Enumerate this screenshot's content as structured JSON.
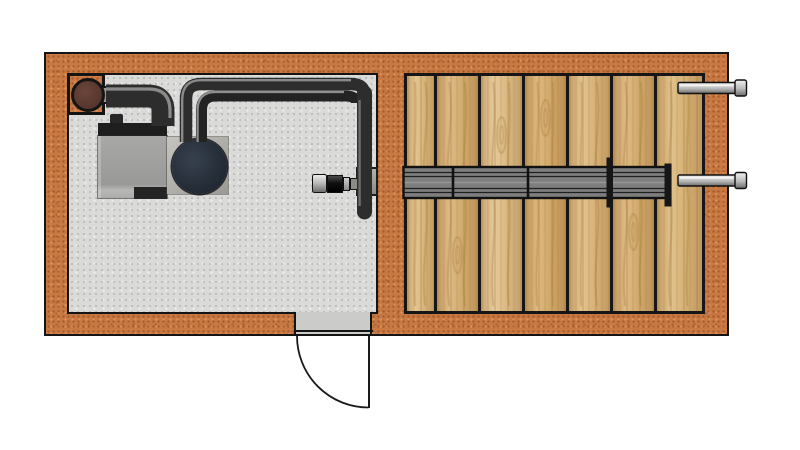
{
  "meta": {
    "diagram_type": "architectural floor plan, top view",
    "visible_text": "none"
  },
  "colors": {
    "background": "#ffffff",
    "outline": "#141414",
    "wall_base": "#c87842",
    "floor_base": "#dadad8",
    "threshold": "#cbcbc9",
    "plank_colors": [
      "#e0bd82",
      "#d9b173",
      "#e3c28b",
      "#d8ae6c",
      "#dfba7e",
      "#d9b071",
      "#ddb87a"
    ],
    "grain": "#a87c3e",
    "bundle_fill": "#7e7e7e",
    "bundle_line": "#1f1f1f",
    "flange_dark": "#161616",
    "pipe_dark": "#2d2d2d",
    "pipe_dark2": "#232323",
    "pipe_hl": "#8a8a8a",
    "pipe_hl2": "#8f8f8f",
    "pipe_hl3": "#6d6d6d",
    "flue_brown": "#5d3a31",
    "blower_dark": "#262e39",
    "pin_light": "#f2f2f2",
    "pin_mid": "#b9b9b9",
    "pin_dark": "#6a6a6a"
  },
  "scene": {
    "wall": {
      "x": 44,
      "y": 52,
      "w": 685,
      "h": 284
    },
    "room": {
      "x": 67,
      "y": 73,
      "w": 311,
      "h": 241
    },
    "deck": {
      "x": 404,
      "y": 73,
      "w": 301,
      "h": 241,
      "plank_widths": [
        27,
        44,
        44,
        44,
        44,
        44,
        48
      ],
      "knots": [
        {
          "plank": 1,
          "cy": 255
        },
        {
          "plank": 2,
          "cy": 135
        },
        {
          "plank": 3,
          "cy": 118
        },
        {
          "plank": 5,
          "cy": 232
        }
      ]
    },
    "flue": {
      "box": {
        "x": 67,
        "y": 73,
        "w": 38,
        "h": 42
      },
      "circle": {
        "cx": 88,
        "cy": 95,
        "r": 14
      },
      "connector": {
        "x": 100,
        "y": 86,
        "w": 13,
        "h": 18
      }
    },
    "heater": {
      "knob": {
        "x": 110,
        "y": 114,
        "w": 13,
        "h": 12
      },
      "top_band": {
        "x": 98,
        "y": 123,
        "w": 69,
        "h": 13
      },
      "body": {
        "x": 98,
        "y": 136,
        "w": 69,
        "h": 62
      },
      "notch": {
        "x": 134,
        "y": 187,
        "w": 33,
        "h": 12
      }
    },
    "blower": {
      "plate": {
        "x": 167,
        "y": 137,
        "w": 61,
        "h": 57
      },
      "fan": {
        "cx": 199.5,
        "cy": 166.5,
        "r": 27.5
      }
    },
    "valve": {
      "flange": {
        "x": 356,
        "y": 167,
        "w": 22,
        "h": 29
      },
      "cap": {
        "x": 312,
        "y": 174,
        "w": 15,
        "h": 19
      },
      "body": {
        "x": 327,
        "y": 174.5,
        "w": 16,
        "h": 18.5
      },
      "collar": {
        "x": 343,
        "y": 176.5,
        "w": 7,
        "h": 14.5
      },
      "connector": {
        "x": 350,
        "y": 178,
        "w": 8,
        "h": 12
      }
    },
    "bundle": {
      "x": 403.5,
      "y": 167,
      "w": 266.5,
      "h": 31,
      "inner_lines_dy": [
        5.5,
        9.5,
        21.5,
        25.5
      ],
      "couplings": [
        453,
        528
      ],
      "flanges": [
        {
          "x": 606.5,
          "y": 157.5,
          "w": 6.5,
          "h": 50
        },
        {
          "x": 664.5,
          "y": 163.5,
          "w": 7,
          "h": 43
        }
      ]
    },
    "pins": {
      "geo": {
        "x": 678,
        "body_w": 57.5,
        "body_h": 11,
        "cap_w": 11.5,
        "cap_h": 16
      },
      "centers_y": [
        88,
        180.5
      ]
    },
    "pipes": [
      {
        "name": "exhaust-pipe",
        "d": "M106,96 H148 Q163,96 163,111 V126",
        "w": 23,
        "color": "pipe_dark"
      },
      {
        "name": "exhaust-highlight",
        "d": "M106,89 H149 Q170,89 170,111 V118",
        "w": 3.2,
        "color": "pipe_hl"
      },
      {
        "name": "loop-pipe-outer",
        "d": "M186,142 V99 Q186,84 201,84 H351 Q364,84 364,94",
        "w": 12.5,
        "color": "pipe_dark"
      },
      {
        "name": "loop-pipe-inner",
        "d": "M201.5,142 V110 Q201.5,96 216,96 H345 Q356.5,96 356.5,103",
        "w": 11,
        "color": "pipe_dark2"
      },
      {
        "name": "valve-riser-pipe",
        "d": "M364.5,93 V212",
        "w": 15,
        "color": "pipe_dark",
        "cap": "round"
      },
      {
        "name": "loop-outer-highlight",
        "d": "M182.2,142 V100 Q182.2,80.2 201,80.2 H351",
        "w": 2.4,
        "color": "pipe_hl"
      },
      {
        "name": "loop-inner-highlight",
        "d": "M197.6,142 V110 Q197.6,92 216,92 H344",
        "w": 2.2,
        "color": "pipe_hl2"
      },
      {
        "name": "riser-highlight",
        "d": "M359.6,100 V206",
        "w": 2.4,
        "color": "pipe_hl3"
      }
    ],
    "door": {
      "threshold": {
        "x": 294,
        "y": 312,
        "w": 78,
        "h": 24
      },
      "leaf": {
        "x": 368,
        "y": 336,
        "w": 2.4,
        "h": 71.5
      },
      "arc": "M297,336 A71.5,71.5 0 0 0 368.5,407.5"
    }
  }
}
